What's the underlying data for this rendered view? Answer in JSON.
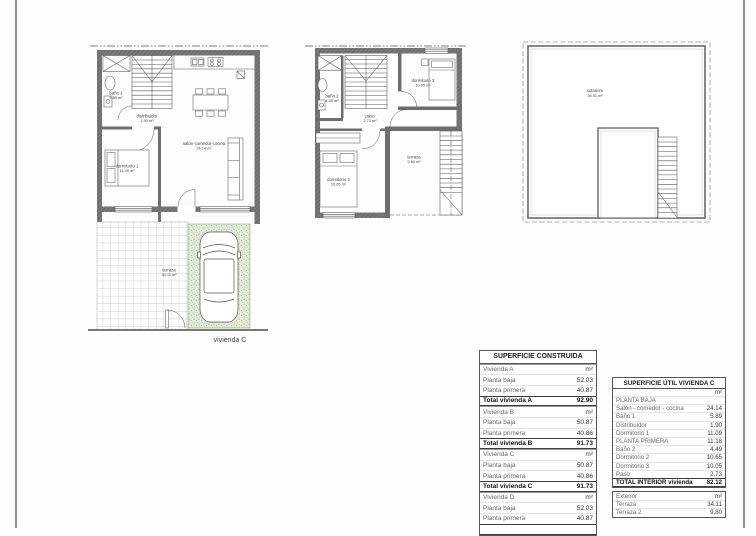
{
  "sheet": {
    "caption_vivienda": "vivienda C"
  },
  "plans": {
    "baja": {
      "rooms": {
        "banyo1": {
          "name": "baño 1",
          "area": "5.89 m²"
        },
        "distribuidor": {
          "name": "distribuidor",
          "area": "1.90 m²"
        },
        "dormitorio1": {
          "name": "dormitorio 1",
          "area": "11.09 m²"
        },
        "salon": {
          "name": "salón-comedor-cocina",
          "area": "24.14 m²"
        },
        "terraza": {
          "name": "terraza",
          "area": "34.11 m²"
        }
      }
    },
    "primera": {
      "rooms": {
        "banyo2": {
          "name": "baño 2",
          "area": "4.49 m²"
        },
        "paso": {
          "name": "paso",
          "area": "2.73 m²"
        },
        "dormitorio3": {
          "name": "dormitorio 3",
          "area": "10.05 m²"
        },
        "dormitorio2": {
          "name": "dormitorio 2",
          "area": "10.65 m²"
        },
        "terraza": {
          "name": "terraza",
          "area": "9.80 m²"
        }
      }
    },
    "solarium": {
      "rooms": {
        "solarium": {
          "name": "solarium",
          "area": "35.91 m²"
        }
      }
    }
  },
  "tables": {
    "construida": {
      "title": "SUPERFICIE CONSTRUIDA",
      "rows": [
        {
          "label": "Vivienda A",
          "value": "m²"
        },
        {
          "label": "Planta baja",
          "value": "52.03"
        },
        {
          "label": "Planta primera",
          "value": "40.87"
        },
        {
          "label": "Total vivienda A",
          "value": "92.90"
        },
        {
          "label": "Vivienda B",
          "value": "m²"
        },
        {
          "label": "Planta baja",
          "value": "50.87"
        },
        {
          "label": "Planta primera",
          "value": "40.86"
        },
        {
          "label": "Total vivienda B",
          "value": "91.73"
        },
        {
          "label": "Vivienda C",
          "value": "m²"
        },
        {
          "label": "Planta baja",
          "value": "50.87"
        },
        {
          "label": "Planta primera",
          "value": "40.86"
        },
        {
          "label": "Total vivienda C",
          "value": "91.73"
        },
        {
          "label": "Vivienda D",
          "value": "m²"
        },
        {
          "label": "Planta baja",
          "value": "52.03"
        },
        {
          "label": "Planta primera",
          "value": "40.87"
        }
      ]
    },
    "util": {
      "title": "SUPERFICIE ÚTIL VIVIENDA C",
      "unit": "m²",
      "rows": [
        {
          "label": "PLANTA BAJA",
          "value": ""
        },
        {
          "label": "Salón - comedor - cocina",
          "value": "24.14"
        },
        {
          "label": "Baño 1",
          "value": "5.89"
        },
        {
          "label": "Distribuidor",
          "value": "1.90"
        },
        {
          "label": "Dormitorio 1",
          "value": "11.09"
        },
        {
          "label": "PLANTA PRIMERA",
          "value": "11.18"
        },
        {
          "label": "Baño 2",
          "value": "4.49"
        },
        {
          "label": "Dormitorio 2",
          "value": "10.65"
        },
        {
          "label": "Dormitorio 3",
          "value": "10.05"
        },
        {
          "label": "Paso",
          "value": "2.73"
        }
      ],
      "total": {
        "label": "TOTAL INTERIOR vivienda",
        "value": "82.12"
      },
      "exterior": {
        "label": "Exterior",
        "unit": "m²",
        "rows": [
          {
            "label": "Terraza",
            "value": "34.11"
          },
          {
            "label": "Terraza 2",
            "value": "9.80"
          }
        ]
      }
    }
  }
}
